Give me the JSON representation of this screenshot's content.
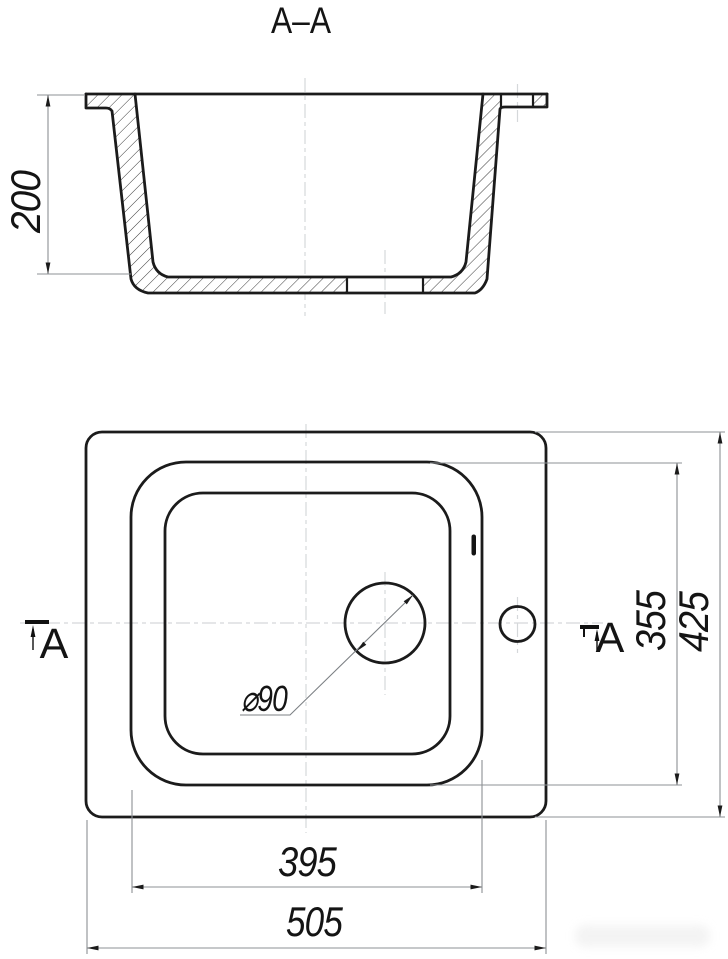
{
  "title": "A–A",
  "section": {
    "label": "A–A",
    "depth_dim": "200"
  },
  "plan": {
    "overall_width_dim": "505",
    "overall_depth_dim": "425",
    "bowl_width_dim": "395",
    "bowl_depth_dim": "355",
    "drain_diameter_dim": "⌀90",
    "marker_left": "A",
    "marker_right": "A"
  },
  "colors": {
    "background": "#ffffff",
    "drawing_line": "#1b1b1b",
    "dimension_line": "#8c9094",
    "centerline": "#d5d8da",
    "hatch": "#3c3c3c"
  }
}
